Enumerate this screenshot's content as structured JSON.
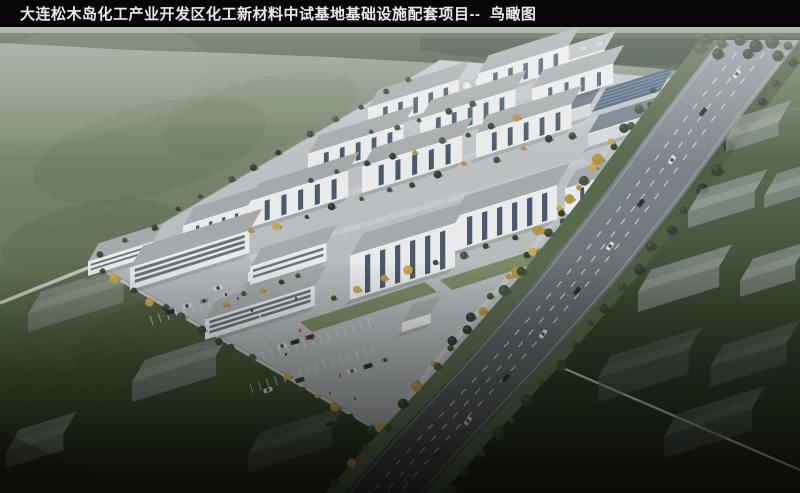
{
  "title_bar": {
    "title": "大连松木岛化工产业开发区化工新材料中试基地基础设施配套项目--  鸟瞰图"
  },
  "palette": {
    "title_bar_bg": "#060606",
    "title_text": "#e9e9e9",
    "haze_field": "#8e978c",
    "field_green": "#6d7b60",
    "dark_green": "#1a2013",
    "tree_band": "#49553f",
    "building_white": "#e8eaeb",
    "building_window": "#4a5a6c",
    "roof_grey": "#a6aaac",
    "warehouse_roof": "#6d7885",
    "solar_panel": "#51647c",
    "campus_pavement": "#bcc0c3",
    "road_grey": "#757b82",
    "lane_marking": "#e8eaea",
    "tree_green": "#3a4b36",
    "tree_gold": "#b5913f",
    "context_block": "#9fa4a7"
  }
}
